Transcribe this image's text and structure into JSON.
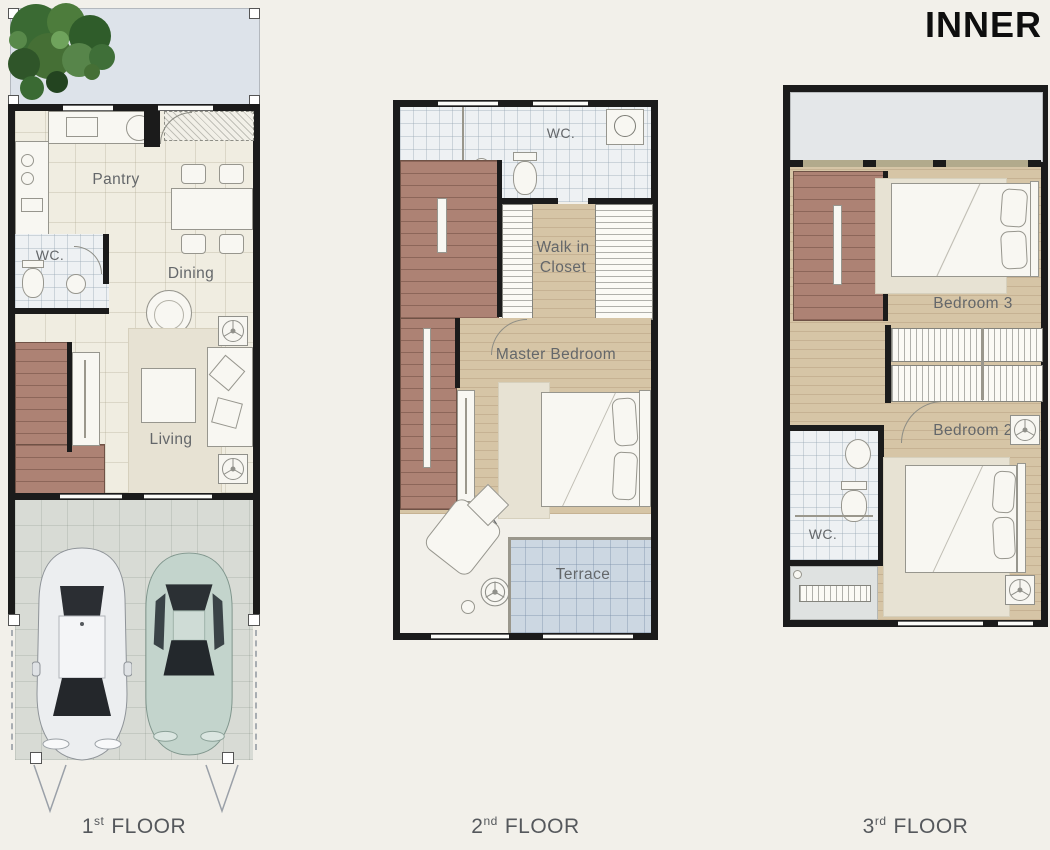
{
  "title": "INNER",
  "colors": {
    "bg": "#f2f0ea",
    "wall": "#1b1b1b",
    "cream": "#f0ede1",
    "wood": "#d6c5a6",
    "stair": "#ad8274",
    "tile": "#eef1f3",
    "garage": "#d8dbd5",
    "terrace": "#ccd7e2",
    "balcony": "#e4e7e9",
    "garden": "#dde3ea",
    "rug": "#e7e2d3",
    "furn": "#f8f7f2",
    "label": "#64676a",
    "caption": "#55585c",
    "title-color": "#0e0e0e"
  },
  "floors": {
    "floor1": {
      "caption": {
        "number": "1",
        "suffix": "st",
        "word": "FLOOR"
      },
      "rooms": {
        "pantry": "Pantry",
        "wc": "WC.",
        "dining": "Dining",
        "living": "Living"
      },
      "features": [
        "garden-terrace",
        "kitchen",
        "staircase",
        "garage"
      ],
      "garage_cars": [
        "white-sedan",
        "green-coupe"
      ]
    },
    "floor2": {
      "caption": {
        "number": "2",
        "suffix": "nd",
        "word": "FLOOR"
      },
      "rooms": {
        "wc": "WC.",
        "walkin": "Walk in Closet",
        "master": "Master Bedroom",
        "relax": "Relax",
        "terrace": "Terrace"
      },
      "features": [
        "bathroom",
        "washer",
        "staircase",
        "bed",
        "lounge-chair"
      ]
    },
    "floor3": {
      "caption": {
        "number": "3",
        "suffix": "rd",
        "word": "FLOOR"
      },
      "rooms": {
        "bedroom3": "Bedroom 3",
        "bedroom2": "Bedroom 2",
        "wc": "WC."
      },
      "features": [
        "balcony",
        "staircase",
        "wardrobes",
        "two-beds",
        "ac-balcony"
      ]
    }
  },
  "icons": [
    "tree-icon",
    "ceiling-fan-icon",
    "washer-icon",
    "toilet-icon",
    "basin-icon",
    "stove-icon",
    "sink-icon",
    "driveway-marker-icon"
  ]
}
